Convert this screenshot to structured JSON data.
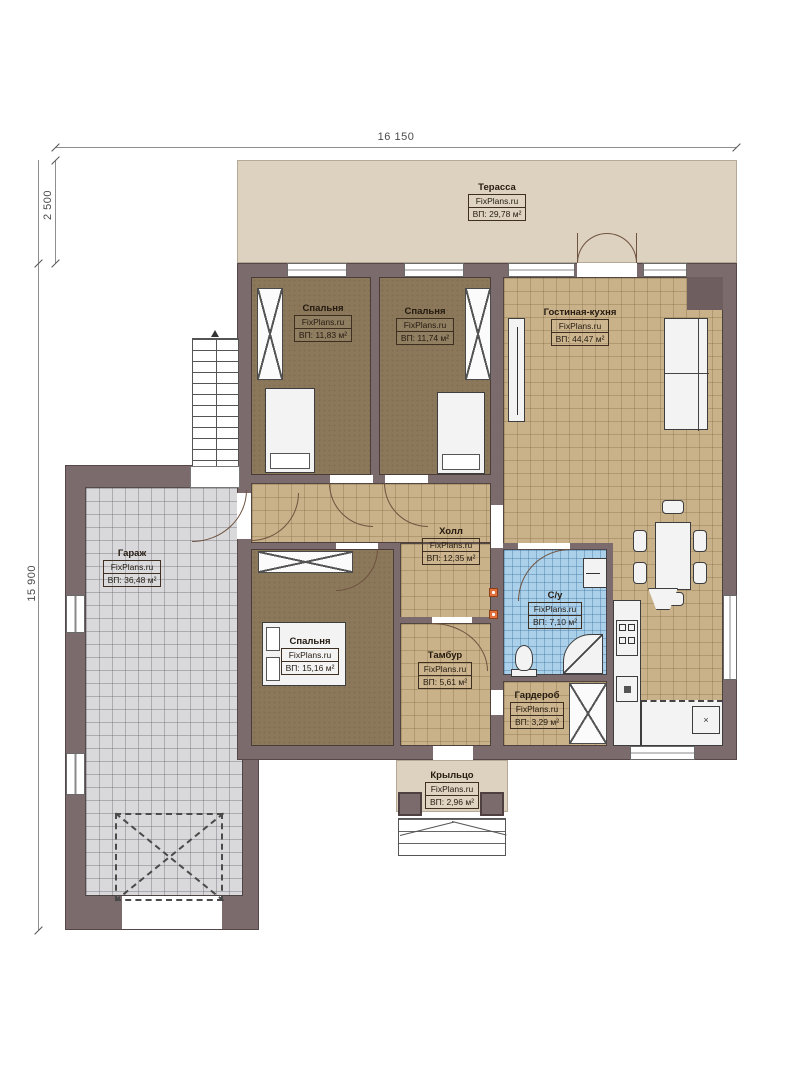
{
  "dimensions": {
    "width_top": "16 150",
    "terrace_depth": "2 500",
    "height_left": "15 900"
  },
  "rooms": {
    "terrace": {
      "name": "Терасса",
      "brand": "FixPlans.ru",
      "area": "ВП: 29,78 м²"
    },
    "bedroom1": {
      "name": "Спальня",
      "brand": "FixPlans.ru",
      "area": "ВП: 11,83 м²"
    },
    "bedroom2": {
      "name": "Спальня",
      "brand": "FixPlans.ru",
      "area": "ВП: 11,74 м²"
    },
    "living_kitchen": {
      "name": "Гостиная-кухня",
      "brand": "FixPlans.ru",
      "area": "ВП: 44,47 м²"
    },
    "garage": {
      "name": "Гараж",
      "brand": "FixPlans.ru",
      "area": "ВП: 36,48 м²"
    },
    "hall": {
      "name": "Холл",
      "brand": "FixPlans.ru",
      "area": "ВП: 12,35 м²"
    },
    "bathroom": {
      "name": "С/у",
      "brand": "FixPlans.ru",
      "area": "ВП: 7,10 м²"
    },
    "bedroom3": {
      "name": "Спальня",
      "brand": "FixPlans.ru",
      "area": "ВП: 15,16 м²"
    },
    "tambur": {
      "name": "Тамбур",
      "brand": "FixPlans.ru",
      "area": "ВП: 5,61 м²"
    },
    "wardrobe": {
      "name": "Гардероб",
      "brand": "FixPlans.ru",
      "area": "ВП: 3,29 м²"
    },
    "porch": {
      "name": "Крыльцо",
      "brand": "FixPlans.ru",
      "area": "ВП: 2,96 м²"
    }
  },
  "marks": {
    "sink_cross": "×"
  },
  "colors": {
    "wall": "#7c6b6d",
    "terrace_floor": "#ddd2bf",
    "bedroom_floor": "#8b7759",
    "tile_tan": "#c9b189",
    "tile_gray": "#d9d9db",
    "tile_blue": "#abd0ea"
  }
}
